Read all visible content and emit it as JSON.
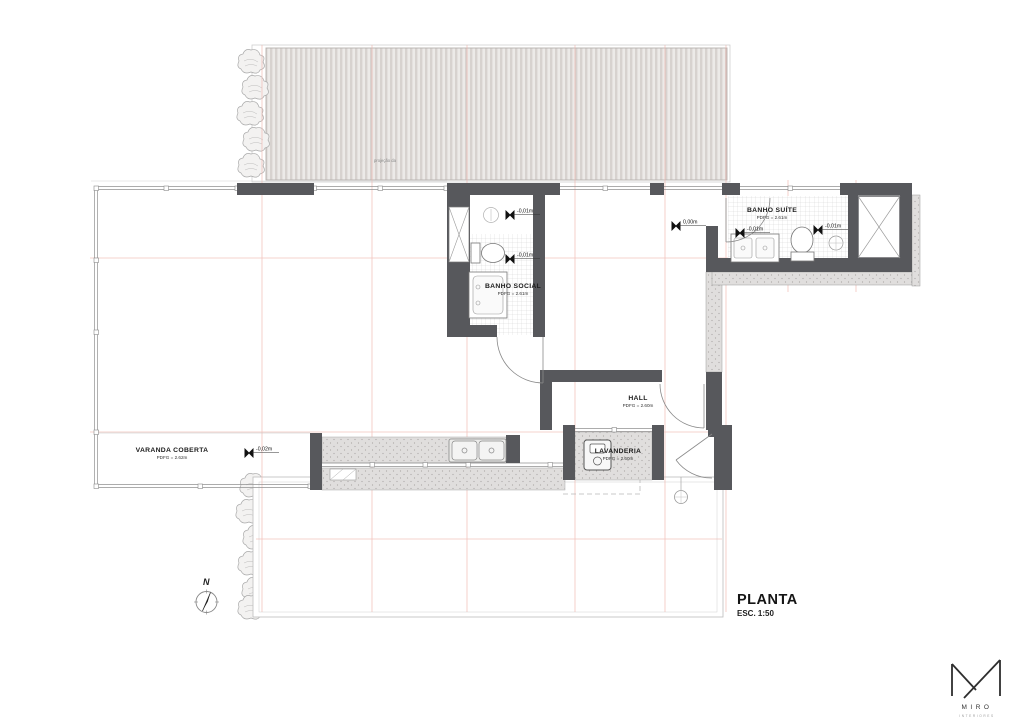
{
  "drawing": {
    "title": "PLANTA",
    "scale": "ESC. 1:50",
    "projection_note": "projeção da",
    "north_label": "N"
  },
  "rooms": {
    "banho_social": {
      "label": "BANHO SOCIAL",
      "pd": "PDFG = 2.61m"
    },
    "banho_suite": {
      "label": "BANHO SUÍTE",
      "pd": "PDFG = 2.61m"
    },
    "hall": {
      "label": "HALL",
      "pd": "PDFG = 2.60m"
    },
    "varanda": {
      "label": "VARANDA COBERTA",
      "pd": "PDFG = 2.62m"
    },
    "lavanderia": {
      "label": "LAVANDERIA",
      "pd": "PDFG = 2.60m"
    }
  },
  "levels": {
    "social_upper": "-0,01m",
    "social_lower": "-0,01m",
    "hall_entry": "0,00m",
    "suite_left": "-0,01m",
    "suite_right": "-0,01m",
    "varanda": "-0,02m"
  },
  "logo": {
    "name": "MIRO",
    "tagline": "INTERIORES"
  },
  "colors": {
    "wall": "#57585c",
    "grid_red": "#efb6ae",
    "deck_stripe": "#d7d2cf",
    "stipple": "#e0dedd",
    "glass": "#909090"
  }
}
